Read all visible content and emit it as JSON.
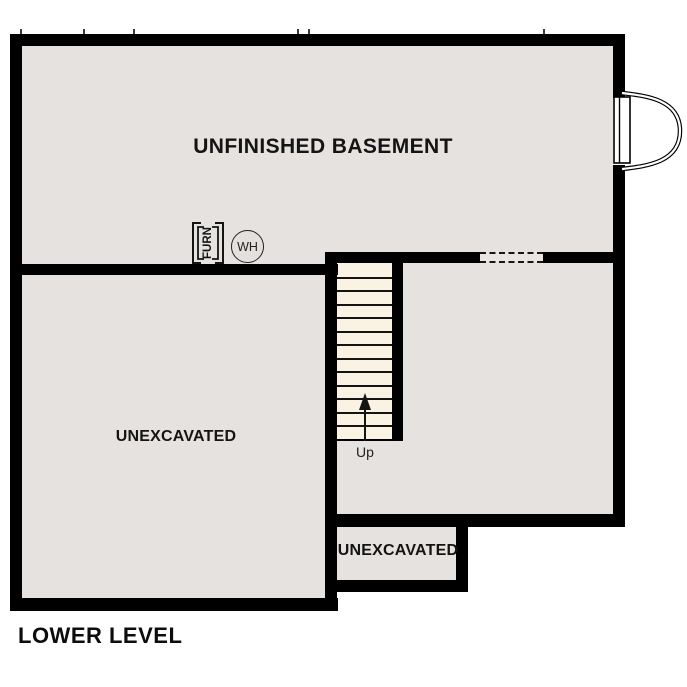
{
  "plan": {
    "title": "LOWER LEVEL",
    "rooms": [
      {
        "id": "basement",
        "label": "UNFINISHED BASEMENT"
      },
      {
        "id": "unexcavated-left",
        "label": "UNEXCAVATED"
      },
      {
        "id": "unexcavated-bottom",
        "label": "UNEXCAVATED"
      }
    ],
    "stairs": {
      "label": "Up",
      "direction": "up",
      "tread_count": 13
    },
    "symbols": {
      "furnace": {
        "label": "FURN"
      },
      "water_heater": {
        "label": "WH"
      }
    }
  },
  "colors": {
    "wall": "#000000",
    "floor": "#e5e2df",
    "stair_tread": "#faf3e4",
    "background": "#ffffff",
    "text": "#141414"
  }
}
